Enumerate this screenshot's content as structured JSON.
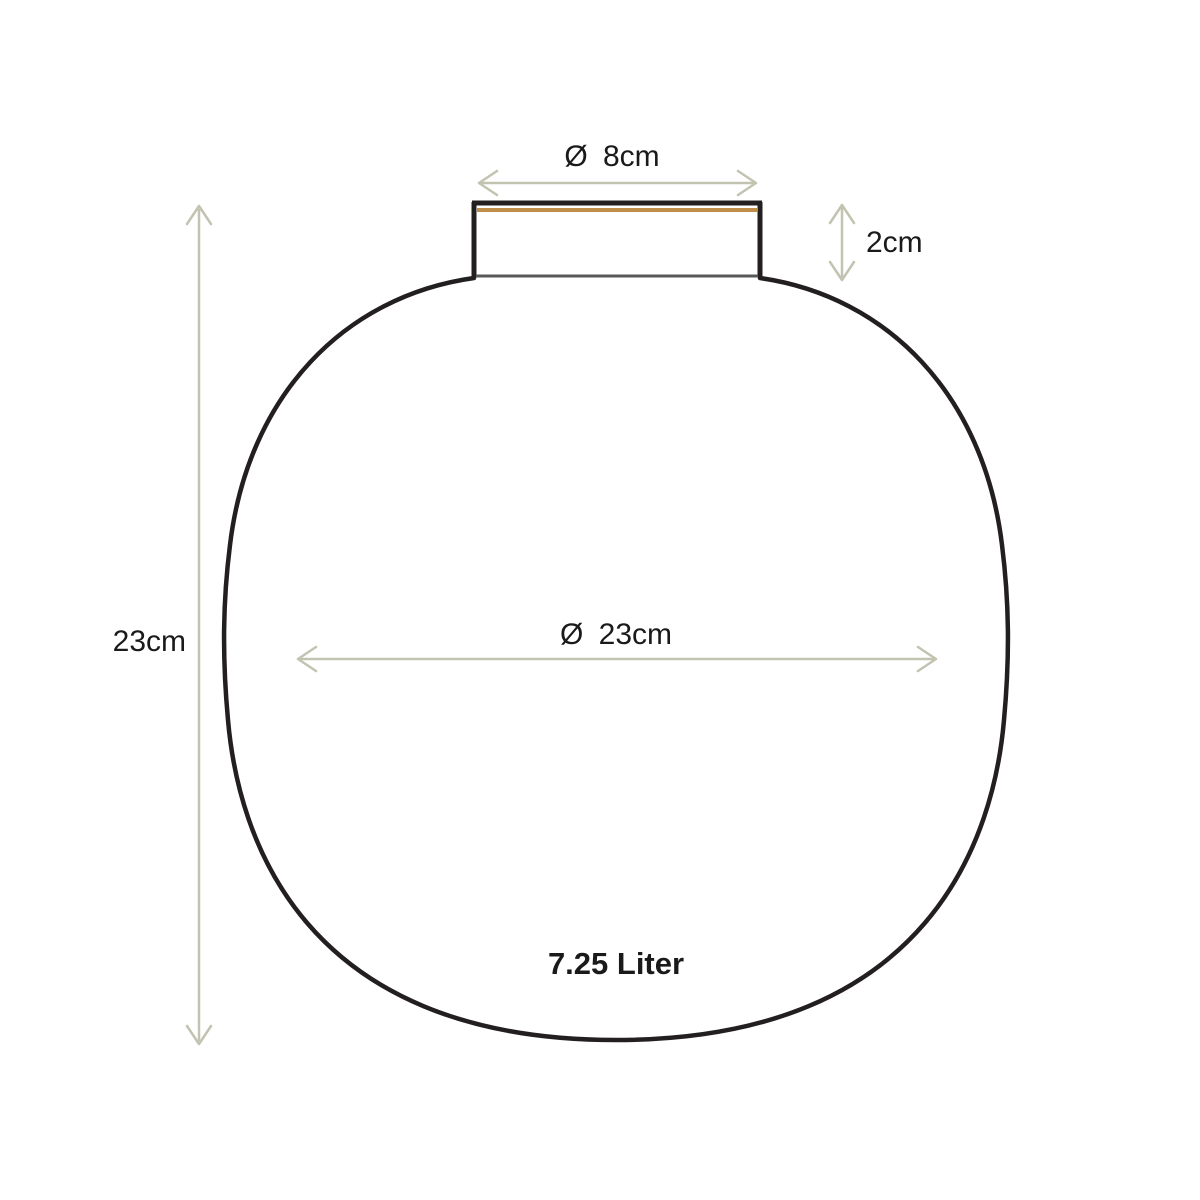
{
  "diagram": {
    "labels": {
      "neck_diameter": "Ø 8cm",
      "neck_height": "2cm",
      "body_height": "23cm",
      "body_diameter": "Ø 23cm",
      "capacity": "7.25 Liter"
    },
    "colors": {
      "outline": "#231f20",
      "neck_base_line": "#58595b",
      "rim_accent": "#bf8e4a",
      "dimension": "#c3c3b2",
      "text": "#1a1a1a"
    }
  }
}
